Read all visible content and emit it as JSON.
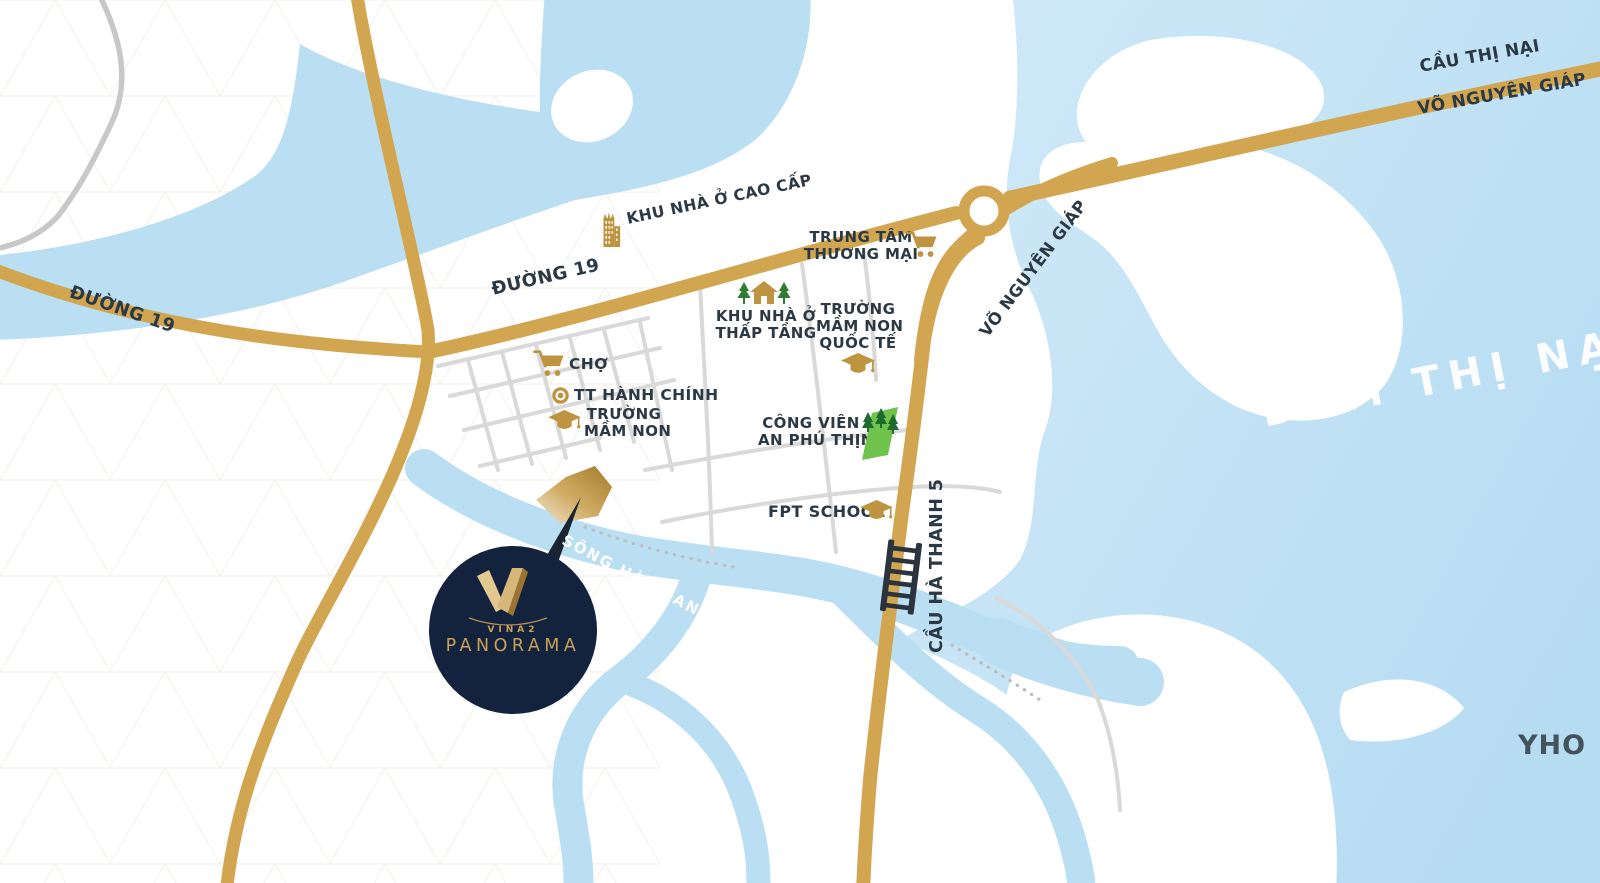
{
  "logo": {
    "brand": "VINA2",
    "name": "PANORAMA"
  },
  "roads": {
    "duong_19": "ĐƯỜNG 19",
    "vo_nguyen_giap": "VÕ NGUYÊN GIÁP",
    "cau_thi_nai": "CẦU THỊ NẠI",
    "cau_ha_thanh_5": "CẦU HÀ THANH 5"
  },
  "waterways": {
    "lagoon": "ĐẦM THỊ NẠI",
    "river": "SÔNG HÀ THANH"
  },
  "landmarks": [
    {
      "id": "khu-nha-o-cao-cap",
      "icon": "building-icon",
      "lines": [
        "KHU NHÀ Ở CAO CẤP"
      ]
    },
    {
      "id": "trung-tam-thuong-mai",
      "icon": "shopping-cart-icon",
      "lines": [
        "TRUNG TÂM",
        "THƯƠNG MẠI"
      ]
    },
    {
      "id": "khu-nha-o-thap-tang",
      "icon": "house-trees-icon",
      "lines": [
        "KHU NHÀ Ở",
        "THẤP TẦNG"
      ]
    },
    {
      "id": "truong-mam-non-quoc-te",
      "icon": "graduation-cap-icon",
      "lines": [
        "TRƯỜNG",
        "MẦM NON",
        "QUỐC TẾ"
      ]
    },
    {
      "id": "cho",
      "icon": "shopping-cart-icon",
      "lines": [
        "CHỢ"
      ]
    },
    {
      "id": "tt-hanh-chinh",
      "icon": "target-icon",
      "lines": [
        "TT HÀNH CHÍNH"
      ]
    },
    {
      "id": "truong-mam-non",
      "icon": "graduation-cap-icon",
      "lines": [
        "TRƯỜNG",
        "MẦM NON"
      ]
    },
    {
      "id": "cong-vien-an-phu-thinh",
      "icon": "park-trees-icon",
      "lines": [
        "CÔNG VIÊN",
        "AN PHÚ THỊNH"
      ]
    },
    {
      "id": "fpt-school",
      "icon": "graduation-cap-icon",
      "lines": [
        "FPT SCHOOL"
      ]
    }
  ],
  "edge_text": {
    "partial_right": "YHO"
  },
  "colors": {
    "road_gold": "#D2A551",
    "water_blue": "#BBDFF2",
    "lagoon_blue": "#C6E4F5",
    "icon_gold": "#BE9440",
    "park_green": "#6FC24B",
    "tree_green": "#2F7D32",
    "label_dark": "#2B3944",
    "logo_navy": "#14233D",
    "logo_gold": "#C7A159",
    "street_gray": "#D9D9D9"
  }
}
